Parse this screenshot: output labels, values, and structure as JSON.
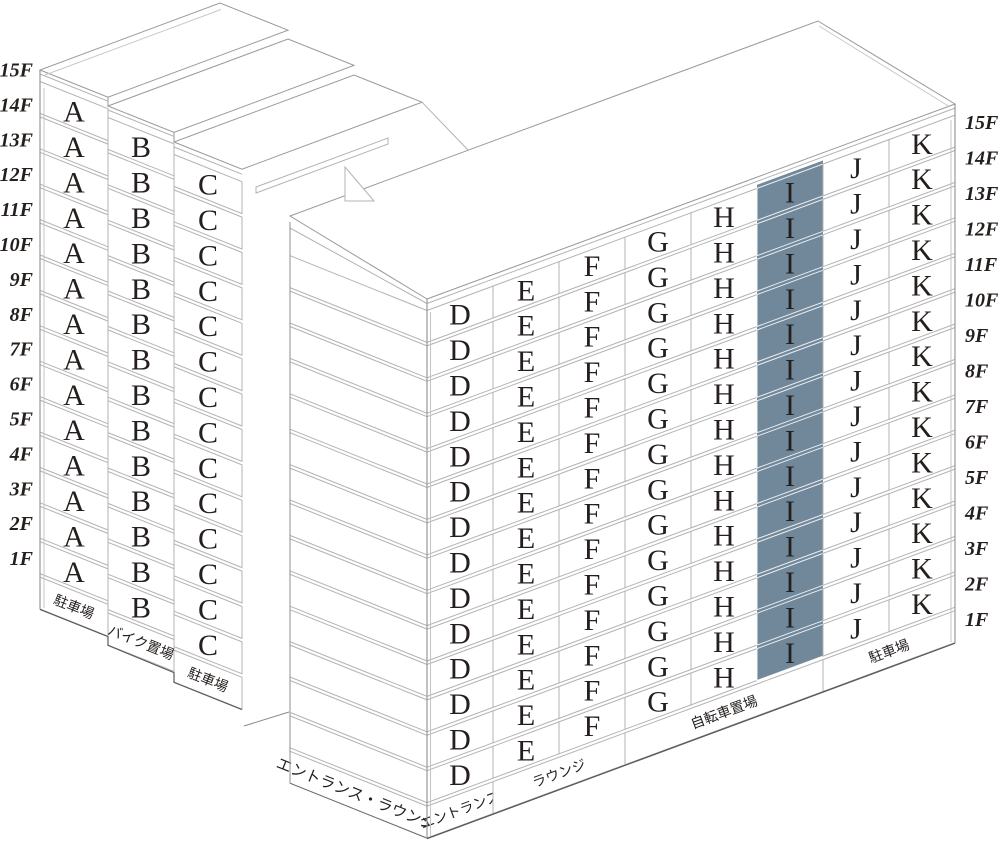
{
  "floors": [
    "15F",
    "14F",
    "13F",
    "12F",
    "11F",
    "10F",
    "9F",
    "8F",
    "7F",
    "6F",
    "5F",
    "4F",
    "3F",
    "2F",
    "1F"
  ],
  "left_wing": {
    "columns": [
      {
        "letter": "A",
        "ground_facility": "駐車場"
      },
      {
        "letter": "B",
        "ground_facility": "バイク置場"
      },
      {
        "letter": "C",
        "ground_facility": "駐車場"
      }
    ]
  },
  "right_wing": {
    "columns": [
      {
        "letter": "D"
      },
      {
        "letter": "E"
      },
      {
        "letter": "F"
      },
      {
        "letter": "G"
      },
      {
        "letter": "H"
      },
      {
        "letter": "I"
      },
      {
        "letter": "J"
      },
      {
        "letter": "K"
      }
    ],
    "highlighted_column": "I",
    "ground_facilities": [
      {
        "label": "エントランス",
        "span": [
          "D"
        ]
      },
      {
        "label": "ラウンジ",
        "span": [
          "E",
          "F"
        ]
      },
      {
        "label": "自転車置場",
        "span": [
          "G",
          "H",
          "I"
        ]
      },
      {
        "label": "駐車場",
        "span": [
          "J",
          "K"
        ]
      }
    ]
  },
  "side_wall": {
    "label": "エントランス・ラウンジ"
  },
  "colors": {
    "highlight": "#71889A",
    "highlight_line": "#ffffff",
    "cell_line": "#b3b3b3",
    "outline": "#999999",
    "ground_line": "#5a5a5a",
    "text": "#241f1d"
  }
}
